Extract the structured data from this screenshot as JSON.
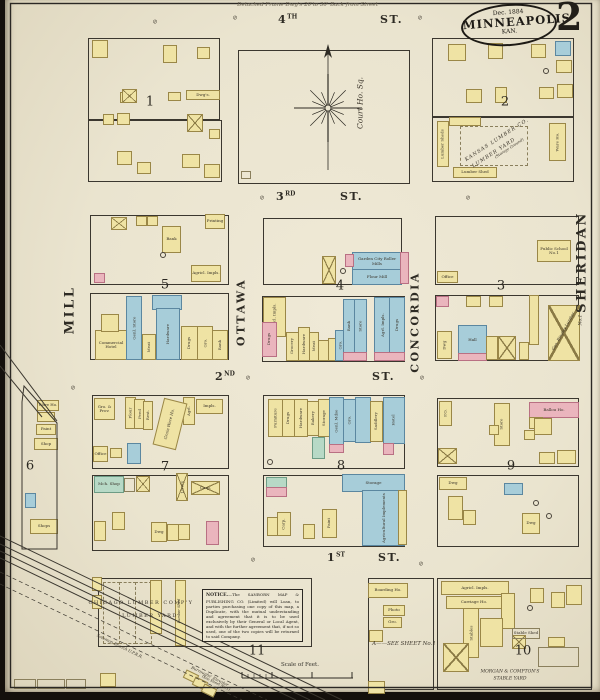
{
  "header": {
    "sheet_number": "2",
    "date": "Dec. 1884",
    "city": "MINNEAPOLIS",
    "state": "KAN.",
    "top_note": "Detached Frame Dwg's 20'to 30' Back from Street"
  },
  "court": {
    "label": "Court Ho. Sq."
  },
  "notice": {
    "title": "NOTICE.",
    "body": "—The SANBORN MAP & PUBLISHING CO. (Limited) will Loan, to parties purchasing one copy of this map, a Duplicate, with the mutual understanding and agreement that it is to be used exclusively by their General or Local Agent, and with the further agreement that, if not so used, one of the two copies will be returned to said Company."
  },
  "scale": {
    "label": "Scale of Feet."
  },
  "palette": {
    "paper": "#eae4cf",
    "frame_wood": "#efe3a4",
    "stone_blue": "#a7cdd9",
    "brick_pink": "#eab5bd",
    "special_green": "#b7d9c6",
    "ink": "#2e2b24"
  },
  "streets": [
    {
      "num": "4",
      "sup": "TH",
      "suffix": "ST.",
      "x1": 278,
      "x2": 380,
      "y": 13
    },
    {
      "num": "3",
      "sup": "RD",
      "suffix": "ST.",
      "x1": 276,
      "x2": 340,
      "y": 190
    },
    {
      "num": "2",
      "sup": "ND",
      "suffix": "ST.",
      "x1": 215,
      "x2": 372,
      "y": 370
    },
    {
      "num": "1",
      "sup": "ST",
      "suffix": "ST.",
      "x1": 327,
      "x2": 378,
      "y": 551
    }
  ],
  "avenues": [
    {
      "name": "MILL",
      "x": 70,
      "y": 310,
      "s": 13
    },
    {
      "name": "OTTAWA",
      "x": 241,
      "y": 312,
      "s": 11
    },
    {
      "name": "CONCORDIA",
      "x": 415,
      "y": 322,
      "s": 11
    },
    {
      "name": "SHERIDAN",
      "x": 582,
      "y": 262,
      "s": 13
    }
  ],
  "blocks": [
    {
      "num": "1",
      "x": 150,
      "y": 102
    },
    {
      "num": "2",
      "x": 505,
      "y": 102
    },
    {
      "num": "5",
      "x": 165,
      "y": 285
    },
    {
      "num": "4",
      "x": 340,
      "y": 286
    },
    {
      "num": "3",
      "x": 501,
      "y": 286
    },
    {
      "num": "6",
      "x": 30,
      "y": 466
    },
    {
      "num": "7",
      "x": 165,
      "y": 467
    },
    {
      "num": "8",
      "x": 341,
      "y": 466
    },
    {
      "num": "9",
      "x": 511,
      "y": 466
    },
    {
      "num": "11",
      "x": 257,
      "y": 651
    },
    {
      "num": "10",
      "x": 523,
      "y": 651
    }
  ],
  "outlines": [
    [
      88,
      38,
      130,
      80
    ],
    [
      88,
      120,
      132,
      60
    ],
    [
      238,
      50,
      170,
      132
    ],
    [
      432,
      38,
      140,
      78
    ],
    [
      432,
      116,
      140,
      64
    ],
    [
      90,
      215,
      137,
      68
    ],
    [
      90,
      293,
      137,
      65
    ],
    [
      263,
      218,
      137,
      65
    ],
    [
      262,
      296,
      141,
      64
    ],
    [
      435,
      216,
      142,
      67
    ],
    [
      435,
      295,
      142,
      64
    ],
    [
      92,
      395,
      135,
      72
    ],
    [
      92,
      475,
      135,
      74
    ],
    [
      263,
      395,
      140,
      72
    ],
    [
      263,
      475,
      140,
      70
    ],
    [
      437,
      398,
      140,
      67
    ],
    [
      437,
      475,
      140,
      70
    ],
    [
      437,
      578,
      153,
      110
    ],
    [
      368,
      578,
      64,
      110
    ],
    [
      98,
      578,
      212,
      67
    ]
  ],
  "buildings": [
    [
      92,
      40,
      14,
      16,
      "y"
    ],
    [
      120,
      92,
      12,
      9,
      "y"
    ],
    [
      163,
      45,
      12,
      16,
      "y"
    ],
    [
      197,
      47,
      11,
      10,
      "y"
    ],
    [
      122,
      89,
      13,
      12,
      "x"
    ],
    [
      168,
      92,
      11,
      7,
      "y"
    ],
    [
      186,
      90,
      32,
      8,
      "y",
      "Dwg's."
    ],
    [
      103,
      114,
      9,
      9,
      "y"
    ],
    [
      117,
      113,
      11,
      10,
      "y"
    ],
    [
      187,
      114,
      14,
      16,
      "x"
    ],
    [
      117,
      151,
      13,
      12,
      "y"
    ],
    [
      137,
      162,
      12,
      10,
      "y"
    ],
    [
      182,
      154,
      16,
      12,
      "y"
    ],
    [
      204,
      164,
      14,
      12,
      "y"
    ],
    [
      209,
      129,
      9,
      8,
      "y"
    ],
    [
      448,
      44,
      16,
      15,
      "y"
    ],
    [
      488,
      43,
      13,
      14,
      "y"
    ],
    [
      531,
      44,
      13,
      12,
      "y"
    ],
    [
      555,
      41,
      14,
      13,
      "b"
    ],
    [
      556,
      60,
      14,
      11,
      "y"
    ],
    [
      557,
      84,
      14,
      12,
      "y"
    ],
    [
      466,
      89,
      14,
      12,
      "y"
    ],
    [
      495,
      87,
      10,
      14,
      "y"
    ],
    [
      539,
      87,
      13,
      10,
      "y"
    ],
    [
      437,
      121,
      10,
      44,
      "y",
      "Lumber Sheds",
      1
    ],
    [
      449,
      117,
      30,
      7,
      "y"
    ],
    [
      549,
      123,
      15,
      36,
      "y",
      "Ware Ho.",
      1
    ],
    [
      453,
      167,
      42,
      9,
      "y",
      "Lumber Shed"
    ],
    [
      111,
      217,
      14,
      11,
      "x"
    ],
    [
      136,
      216,
      9,
      8,
      "y"
    ],
    [
      147,
      216,
      9,
      8,
      "y"
    ],
    [
      162,
      226,
      17,
      25,
      "y",
      "Bank"
    ],
    [
      205,
      214,
      18,
      13,
      "y",
      "Printing"
    ],
    [
      191,
      265,
      28,
      15,
      "y",
      "Agricl. Impls."
    ],
    [
      94,
      273,
      9,
      8,
      "p"
    ],
    [
      95,
      330,
      30,
      28,
      "y",
      "Commercial Hotel"
    ],
    [
      101,
      314,
      16,
      16,
      "y"
    ],
    [
      126,
      296,
      14,
      62,
      "b",
      "Genl. Store",
      1
    ],
    [
      142,
      334,
      12,
      24,
      "y",
      "Meat",
      1
    ],
    [
      152,
      295,
      28,
      13,
      "b"
    ],
    [
      156,
      308,
      22,
      50,
      "b",
      "Hardware",
      1
    ],
    [
      181,
      326,
      15,
      32,
      "y",
      "Drugs",
      1
    ],
    [
      197,
      326,
      14,
      32,
      "y",
      "Gro.",
      1
    ],
    [
      212,
      330,
      14,
      28,
      "y",
      "Bank",
      1
    ],
    [
      352,
      252,
      48,
      17,
      "b",
      "Garden City Roller Mills"
    ],
    [
      352,
      269,
      48,
      14,
      "b",
      "Flour Mill"
    ],
    [
      345,
      254,
      7,
      11,
      "p"
    ],
    [
      400,
      252,
      7,
      30,
      "p"
    ],
    [
      322,
      256,
      12,
      26,
      "x"
    ],
    [
      263,
      297,
      21,
      38,
      "y",
      "Agricl. Impls.",
      1
    ],
    [
      262,
      322,
      13,
      33,
      "p",
      "Drugs",
      1
    ],
    [
      286,
      332,
      11,
      27,
      "y",
      "Grocery",
      1
    ],
    [
      298,
      327,
      10,
      32,
      "y",
      "Hardware",
      1
    ],
    [
      309,
      332,
      8,
      27,
      "y",
      "Meat",
      1
    ],
    [
      318,
      340,
      9,
      19,
      "y"
    ],
    [
      328,
      338,
      7,
      21,
      "y"
    ],
    [
      335,
      330,
      8,
      29,
      "b",
      "Gro.",
      1
    ],
    [
      343,
      299,
      11,
      53,
      "b",
      "Bank",
      1
    ],
    [
      354,
      299,
      11,
      53,
      "b",
      "Store",
      1
    ],
    [
      374,
      297,
      15,
      55,
      "b",
      "Agrl. Impls.",
      1
    ],
    [
      389,
      297,
      14,
      55,
      "b",
      "Drugs",
      1
    ],
    [
      343,
      352,
      22,
      7,
      "p"
    ],
    [
      374,
      352,
      29,
      7,
      "p"
    ],
    [
      537,
      240,
      32,
      20,
      "y",
      "Public School No.1"
    ],
    [
      437,
      271,
      19,
      10,
      "y",
      "Office"
    ],
    [
      436,
      296,
      11,
      9,
      "p"
    ],
    [
      466,
      296,
      13,
      9,
      "y"
    ],
    [
      489,
      296,
      12,
      9,
      "y"
    ],
    [
      458,
      325,
      27,
      28,
      "b",
      "Hall"
    ],
    [
      458,
      353,
      27,
      6,
      "p"
    ],
    [
      437,
      331,
      13,
      26,
      "y",
      "Dwg",
      1
    ],
    [
      486,
      336,
      10,
      22,
      "y"
    ],
    [
      498,
      336,
      16,
      22,
      "x"
    ],
    [
      519,
      342,
      8,
      16,
      "y"
    ],
    [
      529,
      295,
      8,
      48,
      "y"
    ],
    [
      548,
      305,
      30,
      54,
      "x"
    ],
    [
      94,
      398,
      19,
      20,
      "y",
      "Gro. & Prov."
    ],
    [
      125,
      397,
      9,
      30,
      "y",
      "Flour",
      1
    ],
    [
      134,
      399,
      9,
      28,
      "y",
      "Feed",
      1
    ],
    [
      143,
      401,
      8,
      27,
      "y",
      "Rest.",
      1
    ],
    [
      183,
      397,
      10,
      26,
      "y",
      "Agrl.",
      1
    ],
    [
      196,
      399,
      25,
      13,
      "y",
      "Impls."
    ],
    [
      127,
      443,
      12,
      19,
      "b"
    ],
    [
      93,
      446,
      13,
      14,
      "y",
      "Office"
    ],
    [
      110,
      448,
      10,
      8,
      "y"
    ],
    [
      94,
      476,
      28,
      15,
      "g",
      "Mch. Shop"
    ],
    [
      124,
      478,
      9,
      12,
      "w"
    ],
    [
      136,
      476,
      12,
      14,
      "x"
    ],
    [
      176,
      473,
      10,
      26,
      "x",
      "Livery",
      1
    ],
    [
      191,
      481,
      27,
      12,
      "x",
      "Carp."
    ],
    [
      112,
      512,
      11,
      16,
      "y"
    ],
    [
      94,
      521,
      10,
      18,
      "y"
    ],
    [
      151,
      522,
      14,
      18,
      "y",
      "Dwg"
    ],
    [
      167,
      524,
      10,
      15,
      "y"
    ],
    [
      178,
      524,
      10,
      14,
      "y"
    ],
    [
      206,
      521,
      11,
      22,
      "p"
    ],
    [
      268,
      399,
      13,
      36,
      "y",
      "Furniture",
      1
    ],
    [
      282,
      399,
      11,
      36,
      "y",
      "Drugs",
      1
    ],
    [
      294,
      399,
      12,
      36,
      "y",
      "Hardware",
      1
    ],
    [
      307,
      401,
      10,
      33,
      "y",
      "Bakery",
      1
    ],
    [
      318,
      399,
      10,
      36,
      "y",
      "Storage",
      1
    ],
    [
      329,
      397,
      13,
      47,
      "b",
      "Genl. Mdse",
      1
    ],
    [
      343,
      399,
      11,
      41,
      "b",
      "Gro.",
      1
    ],
    [
      355,
      397,
      14,
      44,
      "b"
    ],
    [
      370,
      401,
      11,
      39,
      "y",
      "Saddlery",
      1
    ],
    [
      383,
      397,
      20,
      45,
      "b",
      "Hotel",
      1
    ],
    [
      312,
      437,
      11,
      20,
      "g"
    ],
    [
      383,
      443,
      9,
      10,
      "p"
    ],
    [
      329,
      444,
      13,
      7,
      "p"
    ],
    [
      342,
      474,
      61,
      16,
      "b",
      "Storage"
    ],
    [
      362,
      490,
      41,
      54,
      "b",
      "Agricultural Implements",
      1
    ],
    [
      266,
      477,
      19,
      9,
      "g"
    ],
    [
      266,
      487,
      19,
      8,
      "p"
    ],
    [
      267,
      517,
      9,
      17,
      "y"
    ],
    [
      277,
      512,
      12,
      22,
      "y",
      "Carp.",
      1
    ],
    [
      303,
      524,
      10,
      13,
      "y"
    ],
    [
      322,
      509,
      13,
      27,
      "y",
      "Paint",
      1
    ],
    [
      398,
      490,
      7,
      53,
      "y"
    ],
    [
      439,
      401,
      11,
      23,
      "y",
      "P.O.",
      1
    ],
    [
      529,
      402,
      48,
      14,
      "p",
      "Ballou Ho."
    ],
    [
      494,
      403,
      14,
      41,
      "y",
      "Store",
      1
    ],
    [
      529,
      417,
      12,
      10,
      "y"
    ],
    [
      534,
      418,
      16,
      15,
      "y"
    ],
    [
      524,
      430,
      9,
      8,
      "y"
    ],
    [
      438,
      448,
      17,
      14,
      "x"
    ],
    [
      539,
      452,
      14,
      10,
      "y"
    ],
    [
      557,
      450,
      17,
      12,
      "y"
    ],
    [
      489,
      425,
      8,
      8,
      "y"
    ],
    [
      439,
      477,
      26,
      11,
      "y",
      "Dwg"
    ],
    [
      504,
      483,
      17,
      10,
      "b"
    ],
    [
      448,
      496,
      13,
      22,
      "y"
    ],
    [
      463,
      510,
      11,
      13,
      "y"
    ],
    [
      522,
      513,
      16,
      19,
      "y",
      "Dwg"
    ],
    [
      441,
      581,
      66,
      12,
      "y",
      "Agricl. Impls."
    ],
    [
      501,
      593,
      12,
      34,
      "y"
    ],
    [
      446,
      596,
      54,
      11,
      "y",
      "Carriage Ho."
    ],
    [
      463,
      608,
      14,
      48,
      "y",
      "Stables",
      1
    ],
    [
      480,
      618,
      21,
      27,
      "y"
    ],
    [
      443,
      643,
      24,
      27,
      "x"
    ],
    [
      512,
      635,
      12,
      12,
      "x"
    ],
    [
      548,
      637,
      15,
      8,
      "y"
    ],
    [
      538,
      647,
      39,
      18,
      "w"
    ],
    [
      530,
      588,
      12,
      13,
      "y"
    ],
    [
      551,
      592,
      12,
      14,
      "y"
    ],
    [
      566,
      585,
      14,
      18,
      "y"
    ],
    [
      512,
      628,
      26,
      9,
      "w",
      "Stable Shed"
    ],
    [
      368,
      583,
      38,
      13,
      "y",
      "Boarding Ho."
    ],
    [
      383,
      605,
      20,
      9,
      "y",
      "Photo"
    ],
    [
      383,
      617,
      17,
      9,
      "y",
      "Gro."
    ],
    [
      369,
      630,
      12,
      10,
      "y"
    ],
    [
      368,
      681,
      15,
      11,
      "y"
    ],
    [
      150,
      580,
      10,
      52,
      "y"
    ],
    [
      175,
      580,
      9,
      64,
      "y"
    ],
    [
      92,
      577,
      8,
      12,
      "y"
    ],
    [
      92,
      595,
      8,
      12,
      "y"
    ],
    [
      100,
      673,
      14,
      12,
      "y"
    ],
    [
      241,
      171,
      8,
      6,
      "w"
    ],
    [
      14,
      679,
      20,
      8,
      "w"
    ],
    [
      37,
      679,
      26,
      8,
      "w"
    ],
    [
      66,
      679,
      18,
      8,
      "w"
    ],
    [
      37,
      400,
      20,
      9,
      "y",
      "Ware Ho."
    ],
    [
      37,
      412,
      16,
      8,
      "y"
    ],
    [
      36,
      424,
      18,
      9,
      "y",
      "Paint"
    ],
    [
      34,
      438,
      22,
      10,
      "y",
      "Shop"
    ],
    [
      25,
      493,
      9,
      13,
      "b"
    ],
    [
      30,
      519,
      26,
      13,
      "y",
      "Shops"
    ]
  ],
  "rot_buildings": [
    [
      158,
      400,
      22,
      46,
      14,
      "y"
    ],
    [
      184,
      672,
      12,
      7,
      26,
      "y"
    ],
    [
      193,
      679,
      12,
      7,
      26,
      "y"
    ],
    [
      202,
      686,
      12,
      7,
      26,
      "y"
    ]
  ],
  "stalls": [
    [
      103,
      582,
      15,
      60
    ],
    [
      119,
      582,
      15,
      60
    ],
    [
      135,
      582,
      15,
      60
    ],
    [
      460,
      126,
      66,
      38
    ]
  ],
  "circles": [
    [
      160,
      252
    ],
    [
      340,
      268
    ],
    [
      543,
      68
    ],
    [
      267,
      459
    ],
    [
      533,
      500
    ],
    [
      546,
      513
    ],
    [
      527,
      605
    ]
  ],
  "hydrants": [
    [
      235,
      18
    ],
    [
      420,
      18
    ],
    [
      262,
      198
    ],
    [
      468,
      198
    ],
    [
      248,
      378
    ],
    [
      422,
      378
    ],
    [
      73,
      388
    ],
    [
      253,
      560
    ],
    [
      421,
      564
    ],
    [
      155,
      22
    ]
  ],
  "labels": [
    {
      "t": "Court Ho. Sq.",
      "x": 360,
      "y": 103,
      "rot": -90,
      "s": 7.5,
      "it": 1
    },
    {
      "t": "Grain Ware Ho.",
      "x": 169,
      "y": 424,
      "rot": -76,
      "s": 4,
      "it": 1
    },
    {
      "t": "Geo. Ringley Lumber",
      "x": 563,
      "y": 331,
      "rot": -61,
      "s": 4,
      "it": 1
    },
    {
      "t": "No.1",
      "x": 581,
      "y": 320,
      "rot": -90,
      "s": 4.5,
      "it": 1
    },
    {
      "t": "KANSAS LUMBER CO.",
      "x": 497,
      "y": 140,
      "rot": -33,
      "s": 5,
      "sp": 1,
      "it": 1
    },
    {
      "t": "LUMBER YARD",
      "x": 494,
      "y": 153,
      "rot": -33,
      "s": 5,
      "sp": 1,
      "it": 1
    },
    {
      "t": "(Storage Ground)",
      "x": 509,
      "y": 148,
      "rot": -33,
      "s": 3.8,
      "it": 1
    },
    {
      "t": "CHICAGO LUMBER COMP'Y",
      "x": 141,
      "y": 603,
      "s": 5,
      "sp": 1.5
    },
    {
      "t": "LUMBER YARD",
      "x": 150,
      "y": 616,
      "s": 5,
      "sp": 1.5
    },
    {
      "t": "MORGAN & COMPTON'S",
      "x": 510,
      "y": 672,
      "s": 4.5,
      "it": 1
    },
    {
      "t": "STABLE YARD",
      "x": 510,
      "y": 679,
      "s": 4.5,
      "it": 1
    },
    {
      "t": "A——SEE SHEET No.1",
      "x": 404,
      "y": 644,
      "s": 5.5,
      "it": 1
    },
    {
      "t": "Burroughs' Elevator",
      "x": 210,
      "y": 676,
      "rot": 26,
      "s": 4,
      "it": 1
    },
    {
      "t": "(See Sheet No.1)",
      "x": 216,
      "y": 683,
      "rot": 26,
      "s": 3.6,
      "it": 1
    },
    {
      "t": "Solomon Branch U.P.R.R.",
      "x": 120,
      "y": 646,
      "rot": 26,
      "s": 4,
      "it": 1
    },
    {
      "t": "Lumber Shed",
      "x": 179,
      "y": 611,
      "rot": -90,
      "s": 3.6,
      "it": 1
    }
  ],
  "railroad": {
    "lines": [
      [
        0,
        536,
        342,
        700
      ],
      [
        0,
        544,
        325,
        700
      ],
      [
        0,
        551,
        310,
        700
      ],
      [
        0,
        558,
        296,
        700
      ]
    ],
    "dashed": [
      [
        0,
        572,
        267,
        700
      ],
      [
        0,
        584,
        242,
        700
      ]
    ]
  },
  "shapes": {
    "block6": [
      [
        24,
        386
      ],
      [
        57,
        423
      ],
      [
        57,
        549
      ],
      [
        22,
        549
      ],
      [
        22,
        402
      ]
    ],
    "diagonals": [
      [
        0,
        345,
        57,
        421
      ],
      [
        0,
        366,
        42,
        417
      ]
    ]
  },
  "compass": {
    "x": 328,
    "y": 108,
    "top": 46,
    "bottom": 170
  }
}
